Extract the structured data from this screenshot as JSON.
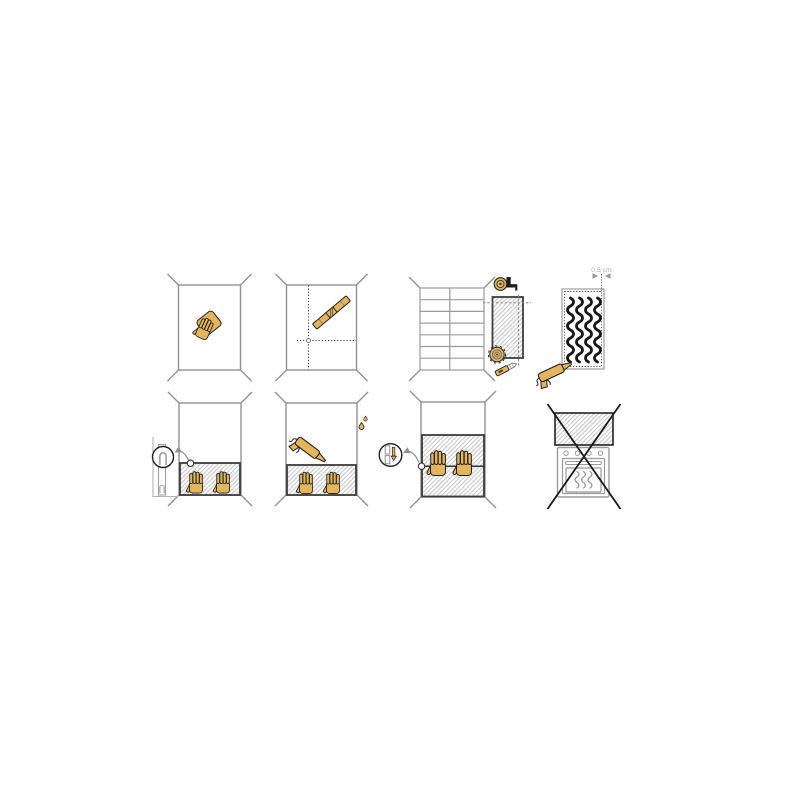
{
  "meta": {
    "title": "Wall panel installation instruction sheet",
    "kind": "illustrated-steps",
    "grid": "2 rows x 4 panels"
  },
  "colors": {
    "paper": "#ffffff",
    "accent": "#E4B55F",
    "ink": "#1f1f1f",
    "wall": "#919191",
    "panel": "#3c3c3c",
    "hatch": "#c4c4c4",
    "muted": "#8f8f8f",
    "label": "#acacac",
    "tool_dark": "#1c1c1c",
    "blade": "#f4f4f4"
  },
  "annotation": {
    "offset_label": "0,5 cm"
  },
  "steps": [
    {
      "id": 1,
      "name": "clean-wall",
      "description": "Wipe the wall clean with a sponge",
      "icons": [
        "wall-outline",
        "sponge-hand"
      ]
    },
    {
      "id": 2,
      "name": "mark-guidelines",
      "description": "Mark plumb and level guide lines using a spirit level",
      "icons": [
        "wall-outline",
        "dotted-guide-lines",
        "spirit-level"
      ]
    },
    {
      "id": 3,
      "name": "measure-and-cut",
      "description": "Measure the tiled wall and cut the panel to size",
      "icons": [
        "tiled-wall",
        "tape-measure",
        "panel-cutout",
        "circular-saw-blade",
        "utility-knife"
      ]
    },
    {
      "id": 4,
      "name": "apply-adhesive",
      "description": "Apply vertical adhesive beads 0,5 cm inside the panel edge",
      "label": "0,5 cm",
      "icons": [
        "panel-back",
        "dotted-margin",
        "adhesive-beads",
        "caulk-gun",
        "offset-arrows"
      ]
    },
    {
      "id": 5,
      "name": "position-first-panel",
      "description": "Rest the first panel on spacer clips and press against the wall",
      "icons": [
        "wall-outline",
        "panel-hatched",
        "pressing-hands",
        "spacer-side-view",
        "spacer-magnifier",
        "pointer-arrow"
      ]
    },
    {
      "id": 6,
      "name": "seal-top-edge",
      "description": "Run sealant along the top edge of the fitted panel",
      "icons": [
        "wall-outline",
        "panel-hatched",
        "pressing-hands",
        "caulk-gun",
        "sealant-drops"
      ]
    },
    {
      "id": 7,
      "name": "fit-next-panel",
      "description": "Slide the next panel down onto the joint and press",
      "icons": [
        "wall-outline",
        "panels-hatched",
        "joint-seam",
        "pressing-hands",
        "joint-magnifier",
        "pointer-arrow"
      ]
    },
    {
      "id": 8,
      "name": "not-above-oven",
      "description": "Do not install the panel above a cooker or oven",
      "icons": [
        "panel-hatched",
        "oven",
        "control-knobs",
        "oven-door",
        "heat-waves",
        "cross-out"
      ]
    }
  ]
}
